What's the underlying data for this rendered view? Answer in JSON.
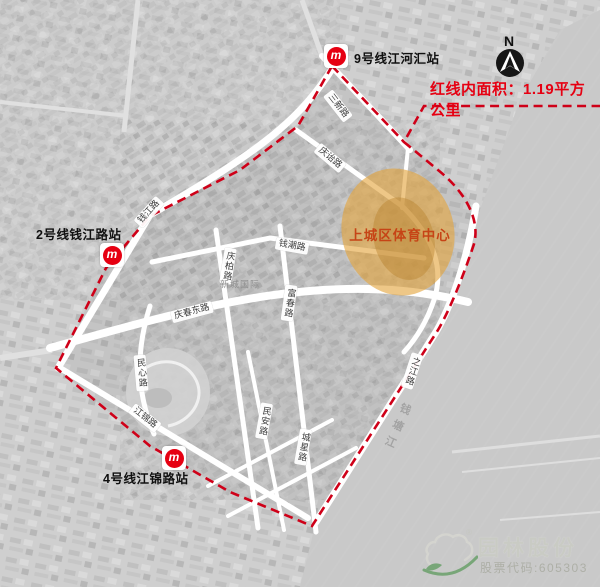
{
  "annotations": {
    "area_note": "红线内面积：1.19平方公里",
    "site_label": "上城区体育中心",
    "compass_letter": "N"
  },
  "stations": [
    {
      "label": "9号线江河汇站",
      "icon_glyph": "m"
    },
    {
      "label": "2号线钱江路站",
      "icon_glyph": "m"
    },
    {
      "label": "4号线江锦路站",
      "icon_glyph": "m"
    }
  ],
  "roads": [
    {
      "label": "三新路"
    },
    {
      "label": "庆诒路"
    },
    {
      "label": "钱江路"
    },
    {
      "label": "庆柏路"
    },
    {
      "label": "钱潮路"
    },
    {
      "label": "富春路"
    },
    {
      "label": "庆春东路"
    },
    {
      "label": "民心路"
    },
    {
      "label": "江锦路"
    },
    {
      "label": "民安路"
    },
    {
      "label": "城星路"
    },
    {
      "label": "之江路"
    }
  ],
  "places": [
    {
      "label": "新城国际"
    },
    {
      "label": "钱塘江"
    }
  ],
  "logo": {
    "company": "园林股份",
    "stock_code": "股票代码:605303",
    "registered_mark": "®"
  },
  "colors": {
    "boundary_red": "#cf0018",
    "metro_red": "#e60012",
    "note_red": "#e60012",
    "site_fill": "#e3a43d",
    "site_text": "#c64416",
    "logo_green": "#6aa06a"
  }
}
